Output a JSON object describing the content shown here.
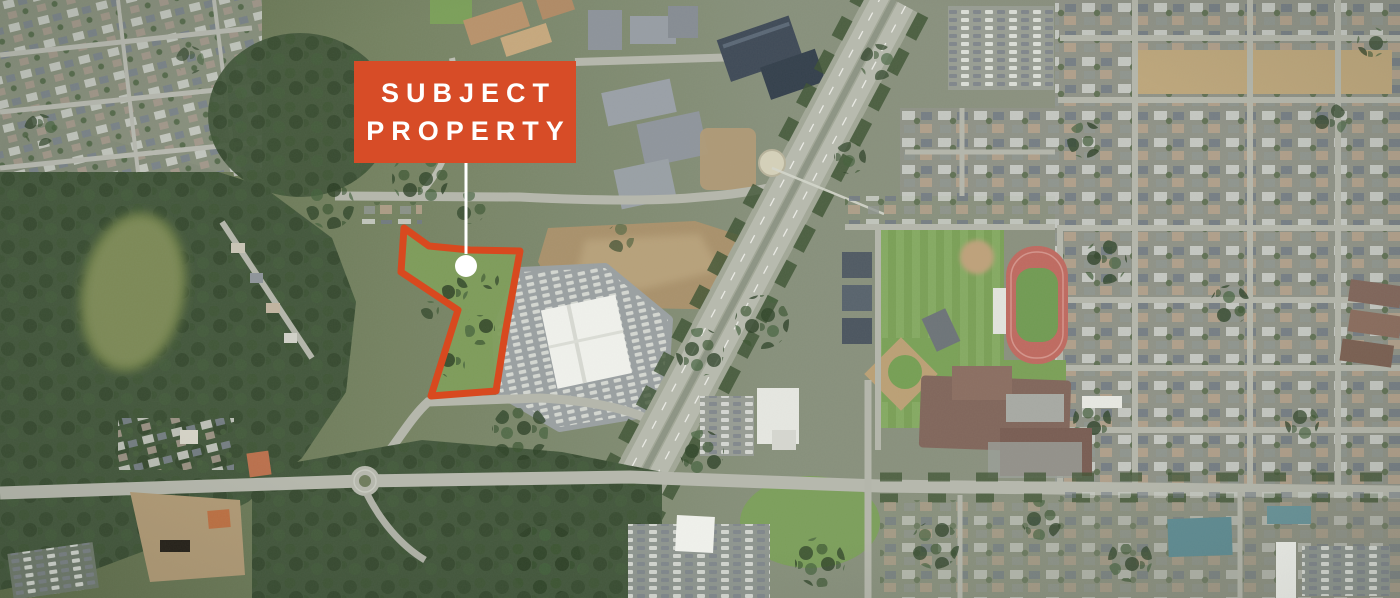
{
  "page": {
    "kind": "aerial-satellite-map",
    "description": "Aerial satellite view of a suburban trade area with a highlighted subject property parcel"
  },
  "annotation": {
    "label": {
      "text_line1": "SUBJECT",
      "text_line2": "PROPERTY",
      "bg_color": "#d74c27",
      "text_color": "#ffffff",
      "x": 354,
      "y": 61,
      "width": 222,
      "height": 102
    },
    "callout": {
      "color": "#ffffff",
      "line_width": 3,
      "x": 466,
      "y1": 163,
      "y2": 254,
      "dot": {
        "cx": 466,
        "cy": 266,
        "r": 11
      }
    },
    "property_outline": {
      "color": "#d8491f",
      "stroke_width": 7,
      "points": "404,228 429,246 470,250 520,251 505,334 496,391 431,396 458,310 401,272"
    }
  },
  "map": {
    "palette": {
      "forest_green": "#42573a",
      "grass_green": "#7ca257",
      "urban_gray": "#8f9286",
      "road_gray": "#b5b8ac",
      "highway_gray": "#a2a896",
      "dirt_tan": "#ab9168",
      "pond_olive": "#7c8a52",
      "track_red": "#c4695e",
      "roof_white": "#f1f2ed",
      "roof_navy": "#3e4a57",
      "roof_brown": "#82655a",
      "school_tan": "#bb9268"
    }
  }
}
